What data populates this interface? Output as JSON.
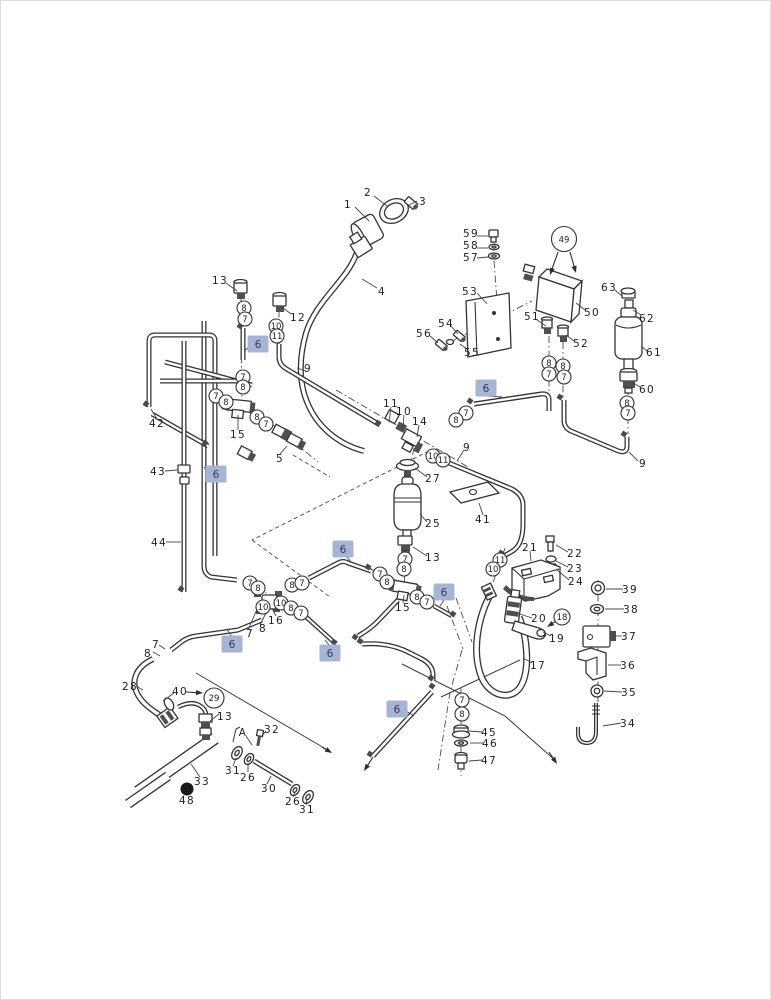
{
  "meta": {
    "background": "#ffffff",
    "line_color": "#333333",
    "highlight_color": "#a7b4d6",
    "canvas": {
      "w": 771,
      "h": 1000
    }
  },
  "diagram": {
    "plain_labels": [
      {
        "t": "1",
        "x": 348,
        "y": 204
      },
      {
        "t": "2",
        "x": 368,
        "y": 192
      },
      {
        "t": "3",
        "x": 423,
        "y": 201
      },
      {
        "t": "4",
        "x": 382,
        "y": 291
      },
      {
        "t": "59",
        "x": 471,
        "y": 233
      },
      {
        "t": "58",
        "x": 471,
        "y": 245
      },
      {
        "t": "57",
        "x": 471,
        "y": 257
      },
      {
        "t": "53",
        "x": 470,
        "y": 291
      },
      {
        "t": "50",
        "x": 592,
        "y": 312
      },
      {
        "t": "51",
        "x": 532,
        "y": 316
      },
      {
        "t": "52",
        "x": 581,
        "y": 343
      },
      {
        "t": "54",
        "x": 446,
        "y": 323
      },
      {
        "t": "55",
        "x": 472,
        "y": 352
      },
      {
        "t": "56",
        "x": 424,
        "y": 333
      },
      {
        "t": "63",
        "x": 609,
        "y": 287
      },
      {
        "t": "62",
        "x": 647,
        "y": 318
      },
      {
        "t": "61",
        "x": 654,
        "y": 352
      },
      {
        "t": "60",
        "x": 647,
        "y": 389
      },
      {
        "t": "13",
        "x": 220,
        "y": 280
      },
      {
        "t": "12",
        "x": 298,
        "y": 317
      },
      {
        "t": "9",
        "x": 308,
        "y": 368
      },
      {
        "t": "42",
        "x": 157,
        "y": 423
      },
      {
        "t": "15",
        "x": 238,
        "y": 434
      },
      {
        "t": "5",
        "x": 280,
        "y": 458
      },
      {
        "t": "43",
        "x": 158,
        "y": 471
      },
      {
        "t": "44",
        "x": 159,
        "y": 542
      },
      {
        "t": "11",
        "x": 391,
        "y": 403
      },
      {
        "t": "10",
        "x": 404,
        "y": 411
      },
      {
        "t": "14",
        "x": 420,
        "y": 421
      },
      {
        "t": "27",
        "x": 433,
        "y": 478
      },
      {
        "t": "25",
        "x": 433,
        "y": 523
      },
      {
        "t": "13",
        "x": 433,
        "y": 557
      },
      {
        "t": "9",
        "x": 467,
        "y": 447
      },
      {
        "t": "41",
        "x": 483,
        "y": 519
      },
      {
        "t": "9",
        "x": 643,
        "y": 463
      },
      {
        "t": "21",
        "x": 530,
        "y": 547
      },
      {
        "t": "22",
        "x": 575,
        "y": 553
      },
      {
        "t": "23",
        "x": 575,
        "y": 568
      },
      {
        "t": "24",
        "x": 576,
        "y": 581
      },
      {
        "t": "20",
        "x": 539,
        "y": 618
      },
      {
        "t": "19",
        "x": 557,
        "y": 638
      },
      {
        "t": "17",
        "x": 538,
        "y": 665
      },
      {
        "t": "39",
        "x": 630,
        "y": 589
      },
      {
        "t": "38",
        "x": 631,
        "y": 609
      },
      {
        "t": "37",
        "x": 629,
        "y": 636
      },
      {
        "t": "36",
        "x": 628,
        "y": 665
      },
      {
        "t": "35",
        "x": 629,
        "y": 692
      },
      {
        "t": "34",
        "x": 628,
        "y": 723
      },
      {
        "t": "16",
        "x": 276,
        "y": 620
      },
      {
        "t": "8",
        "x": 263,
        "y": 628
      },
      {
        "t": "7",
        "x": 250,
        "y": 633
      },
      {
        "t": "7",
        "x": 156,
        "y": 644
      },
      {
        "t": "8",
        "x": 148,
        "y": 653
      },
      {
        "t": "28",
        "x": 130,
        "y": 686
      },
      {
        "t": "40",
        "x": 180,
        "y": 691
      },
      {
        "t": "13",
        "x": 225,
        "y": 716
      },
      {
        "t": "32",
        "x": 272,
        "y": 729
      },
      {
        "t": "A",
        "x": 243,
        "y": 732
      },
      {
        "t": "33",
        "x": 202,
        "y": 781
      },
      {
        "t": "48",
        "x": 187,
        "y": 800
      },
      {
        "t": "31",
        "x": 233,
        "y": 770
      },
      {
        "t": "26",
        "x": 248,
        "y": 777
      },
      {
        "t": "30",
        "x": 269,
        "y": 788
      },
      {
        "t": "26",
        "x": 293,
        "y": 801
      },
      {
        "t": "31",
        "x": 307,
        "y": 809
      },
      {
        "t": "15",
        "x": 403,
        "y": 607
      },
      {
        "t": "45",
        "x": 489,
        "y": 732
      },
      {
        "t": "46",
        "x": 490,
        "y": 743
      },
      {
        "t": "47",
        "x": 489,
        "y": 760
      }
    ],
    "circled_labels": [
      {
        "t": "49",
        "x": 564,
        "y": 239,
        "r": 12.5,
        "fs": 10
      },
      {
        "t": "29",
        "x": 214,
        "y": 698,
        "r": 10,
        "fs": 9
      },
      {
        "t": "18",
        "x": 562,
        "y": 617,
        "r": 8,
        "fs": 8.5
      },
      {
        "t": "8",
        "x": 244,
        "y": 308
      },
      {
        "t": "7",
        "x": 245,
        "y": 319
      },
      {
        "t": "10",
        "x": 276,
        "y": 326
      },
      {
        "t": "11",
        "x": 277,
        "y": 336
      },
      {
        "t": "7",
        "x": 243,
        "y": 377
      },
      {
        "t": "8",
        "x": 243,
        "y": 387
      },
      {
        "t": "7",
        "x": 216,
        "y": 396
      },
      {
        "t": "8",
        "x": 226,
        "y": 402
      },
      {
        "t": "8",
        "x": 257,
        "y": 417
      },
      {
        "t": "7",
        "x": 266,
        "y": 424
      },
      {
        "t": "7",
        "x": 466,
        "y": 413
      },
      {
        "t": "8",
        "x": 456,
        "y": 420
      },
      {
        "t": "10",
        "x": 433,
        "y": 456
      },
      {
        "t": "11",
        "x": 443,
        "y": 460
      },
      {
        "t": "8",
        "x": 549,
        "y": 363
      },
      {
        "t": "7",
        "x": 549,
        "y": 374
      },
      {
        "t": "8",
        "x": 563,
        "y": 366
      },
      {
        "t": "7",
        "x": 564,
        "y": 377
      },
      {
        "t": "8",
        "x": 627,
        "y": 403
      },
      {
        "t": "7",
        "x": 628,
        "y": 413
      },
      {
        "t": "7",
        "x": 405,
        "y": 559
      },
      {
        "t": "8",
        "x": 404,
        "y": 569
      },
      {
        "t": "7",
        "x": 380,
        "y": 574
      },
      {
        "t": "8",
        "x": 387,
        "y": 582
      },
      {
        "t": "8",
        "x": 417,
        "y": 597
      },
      {
        "t": "7",
        "x": 427,
        "y": 602
      },
      {
        "t": "7",
        "x": 250,
        "y": 583
      },
      {
        "t": "8",
        "x": 258,
        "y": 588
      },
      {
        "t": "8",
        "x": 292,
        "y": 585
      },
      {
        "t": "7",
        "x": 302,
        "y": 583
      },
      {
        "t": "10",
        "x": 263,
        "y": 607
      },
      {
        "t": "10",
        "x": 281,
        "y": 603
      },
      {
        "t": "8",
        "x": 291,
        "y": 608
      },
      {
        "t": "7",
        "x": 301,
        "y": 613
      },
      {
        "t": "11",
        "x": 500,
        "y": 560
      },
      {
        "t": "10",
        "x": 493,
        "y": 569
      },
      {
        "t": "7",
        "x": 462,
        "y": 700
      },
      {
        "t": "8",
        "x": 462,
        "y": 714
      }
    ],
    "highlighted_labels": [
      {
        "t": "6",
        "x": 258,
        "y": 344
      },
      {
        "t": "6",
        "x": 486,
        "y": 388
      },
      {
        "t": "6",
        "x": 216,
        "y": 474
      },
      {
        "t": "6",
        "x": 343,
        "y": 549
      },
      {
        "t": "6",
        "x": 232,
        "y": 644
      },
      {
        "t": "6",
        "x": 330,
        "y": 653
      },
      {
        "t": "6",
        "x": 444,
        "y": 592
      },
      {
        "t": "6",
        "x": 397,
        "y": 709
      }
    ],
    "leader_lines": [
      [
        355,
        207,
        369,
        221
      ],
      [
        374,
        196,
        387,
        206
      ],
      [
        417,
        201,
        409,
        205
      ],
      [
        377,
        288,
        362,
        279
      ],
      [
        477,
        236,
        488,
        236
      ],
      [
        477,
        248,
        488,
        248
      ],
      [
        477,
        258,
        488,
        257
      ],
      [
        477,
        293,
        487,
        304
      ],
      [
        585,
        310,
        576,
        303
      ],
      [
        537,
        320,
        546,
        326
      ],
      [
        574,
        341,
        566,
        335
      ],
      [
        451,
        326,
        458,
        334
      ],
      [
        467,
        349,
        460,
        344
      ],
      [
        430,
        336,
        438,
        343
      ],
      [
        615,
        290,
        622,
        296
      ],
      [
        641,
        315,
        633,
        310
      ],
      [
        647,
        351,
        641,
        346
      ],
      [
        640,
        387,
        632,
        382
      ],
      [
        226,
        283,
        237,
        291
      ],
      [
        291,
        314,
        282,
        307
      ],
      [
        306,
        371,
        297,
        368
      ],
      [
        157,
        419,
        151,
        409
      ],
      [
        238,
        430,
        238,
        415
      ],
      [
        280,
        454,
        287,
        446
      ],
      [
        165,
        471,
        177,
        470
      ],
      [
        166,
        542,
        181,
        542
      ],
      [
        391,
        407,
        389,
        422
      ],
      [
        404,
        415,
        403,
        429
      ],
      [
        419,
        425,
        417,
        437
      ],
      [
        427,
        477,
        415,
        468
      ],
      [
        427,
        522,
        420,
        514
      ],
      [
        427,
        556,
        413,
        547
      ],
      [
        464,
        450,
        457,
        461
      ],
      [
        483,
        515,
        479,
        503
      ],
      [
        638,
        461,
        629,
        452
      ],
      [
        530,
        551,
        531,
        561
      ],
      [
        568,
        552,
        556,
        545
      ],
      [
        568,
        567,
        556,
        561
      ],
      [
        569,
        580,
        556,
        569
      ],
      [
        532,
        618,
        517,
        613
      ],
      [
        551,
        636,
        543,
        632
      ],
      [
        532,
        663,
        523,
        658
      ],
      [
        623,
        589,
        606,
        589
      ],
      [
        624,
        609,
        605,
        609
      ],
      [
        622,
        636,
        612,
        636
      ],
      [
        621,
        665,
        608,
        665
      ],
      [
        622,
        692,
        604,
        691
      ],
      [
        621,
        723,
        603,
        726
      ],
      [
        276,
        616,
        272,
        608
      ],
      [
        260,
        625,
        267,
        611
      ],
      [
        248,
        630,
        258,
        607
      ],
      [
        159,
        645,
        165,
        649
      ],
      [
        153,
        652,
        160,
        656
      ],
      [
        136,
        686,
        143,
        690
      ],
      [
        174,
        693,
        163,
        701
      ],
      [
        219,
        714,
        210,
        721
      ],
      [
        266,
        731,
        261,
        737
      ],
      [
        200,
        777,
        191,
        764
      ],
      [
        233,
        766,
        236,
        758
      ],
      [
        248,
        772,
        248,
        763
      ],
      [
        267,
        784,
        271,
        776
      ],
      [
        293,
        797,
        295,
        792
      ],
      [
        306,
        805,
        307,
        799
      ],
      [
        403,
        603,
        404,
        595
      ],
      [
        482,
        732,
        469,
        731
      ],
      [
        483,
        743,
        470,
        743
      ],
      [
        482,
        760,
        469,
        761
      ],
      [
        249,
        347,
        244,
        351
      ],
      [
        487,
        396,
        502,
        397
      ],
      [
        207,
        471,
        204,
        467
      ],
      [
        346,
        556,
        352,
        563
      ],
      [
        232,
        637,
        227,
        629
      ],
      [
        330,
        646,
        325,
        640
      ],
      [
        444,
        600,
        440,
        606
      ],
      [
        406,
        711,
        414,
        716
      ],
      [
        246,
        736,
        252,
        745
      ]
    ],
    "arrows": [
      [
        558,
        252,
        550,
        275
      ],
      [
        570,
        252,
        576,
        273
      ],
      [
        186,
        692,
        203,
        693
      ],
      [
        556,
        621,
        547,
        627
      ],
      [
        373,
        757,
        364,
        771
      ],
      [
        322,
        747,
        332,
        753
      ],
      [
        549,
        752,
        557,
        764
      ]
    ]
  }
}
